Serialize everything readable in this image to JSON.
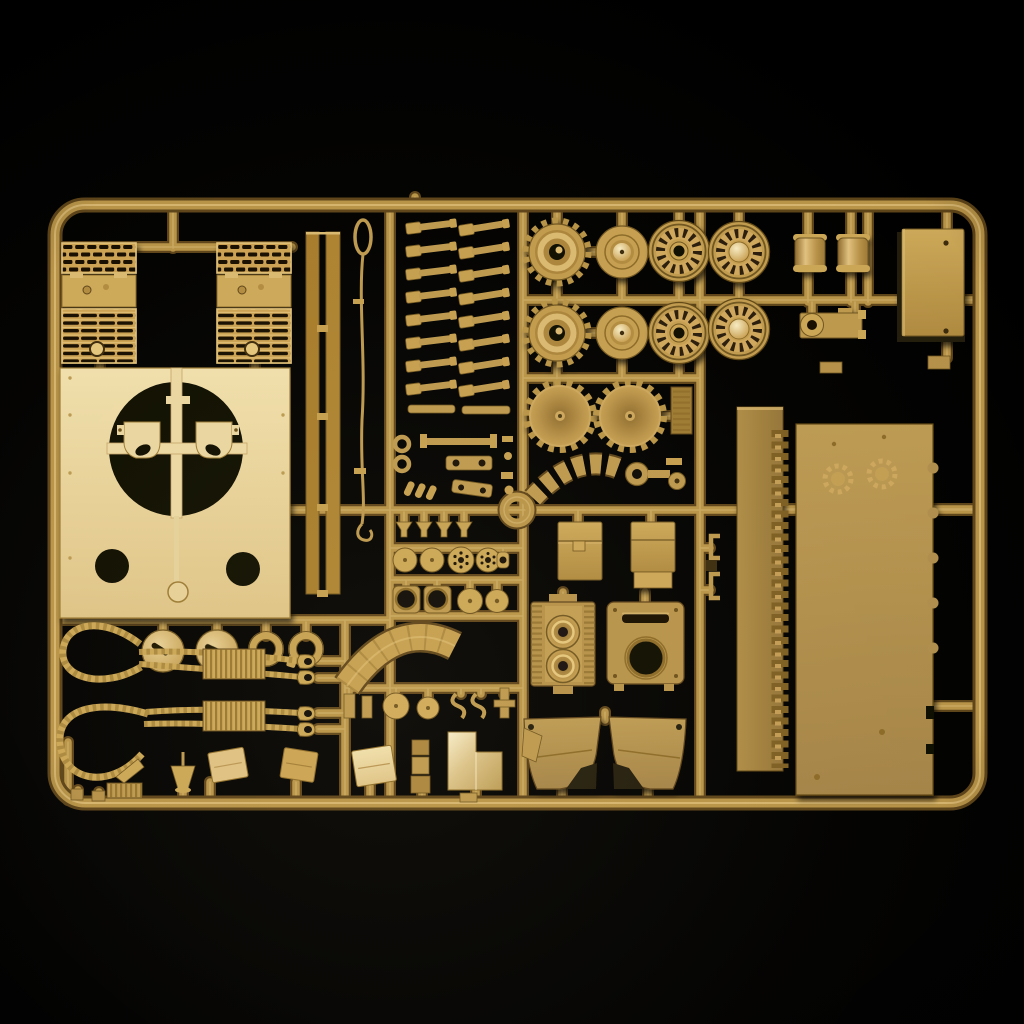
{
  "scene": {
    "description": "Photograph of an injection-molded plastic model kit sprue with tan tank parts on a black background",
    "background_color": "#000000"
  },
  "palette": {
    "bg": "#000000",
    "runner": "#b6934a",
    "runnerDark": "#5c431a",
    "runnerHi": "#dcbe7e",
    "plastic": "#c49e52",
    "plasticLight": "#ecd9a8",
    "plasticMid": "#b2904c",
    "plasticDark": "#8a6a2a",
    "plasticDeep": "#4a3812",
    "hole": "#0c0905",
    "highlight": "#f0e2b8"
  },
  "sprue": {
    "frame": "rounded rectangular runner frame",
    "part_groups": [
      {
        "name": "engine-deck-grille",
        "count": 2
      },
      {
        "name": "rear-hull-plate-with-turret-ring",
        "count": 1
      },
      {
        "name": "seat-bracket",
        "count": 2
      },
      {
        "name": "side-skirt-strip",
        "count": 2
      },
      {
        "name": "antenna-wire",
        "count": 1
      },
      {
        "name": "torsion-bar",
        "count": 16
      },
      {
        "name": "drive-sprocket",
        "count": 2
      },
      {
        "name": "hub-wheel",
        "count": 2
      },
      {
        "name": "spoked-road-wheel",
        "count": 4
      },
      {
        "name": "dished-sprocket",
        "count": 2
      },
      {
        "name": "exhaust-cylinder",
        "count": 2
      },
      {
        "name": "muffler-bracket",
        "count": 1
      },
      {
        "name": "stowage-box",
        "count": 1
      },
      {
        "name": "vent-plate",
        "count": 1
      },
      {
        "name": "track-rack-arc",
        "count": 1
      },
      {
        "name": "ring-hub-fitting",
        "count": 1
      },
      {
        "name": "periscope-cup",
        "count": 4
      },
      {
        "name": "disc-fitting",
        "count": 8
      },
      {
        "name": "flanged-hatch",
        "count": 2
      },
      {
        "name": "stowage-bin",
        "count": 2
      },
      {
        "name": "engine-fan-housing",
        "count": 1
      },
      {
        "name": "rear-access-plate",
        "count": 1
      },
      {
        "name": "fender",
        "count": 2
      },
      {
        "name": "inner-hull-panel",
        "count": 1
      },
      {
        "name": "track-tooth-strip",
        "count": 1
      },
      {
        "name": "hull-side-panel",
        "count": 1
      },
      {
        "name": "slotted-hatch-disc",
        "count": 2
      },
      {
        "name": "towing-shackle",
        "count": 2
      },
      {
        "name": "tow-cable",
        "count": 2
      },
      {
        "name": "fender-arc",
        "count": 1
      },
      {
        "name": "mudflap",
        "count": 3
      },
      {
        "name": "funnel-fitting",
        "count": 1
      },
      {
        "name": "ribbed-grate",
        "count": 1
      },
      {
        "name": "l-shaped-plate",
        "count": 1
      },
      {
        "name": "sprue-ring",
        "count": 1
      }
    ]
  }
}
